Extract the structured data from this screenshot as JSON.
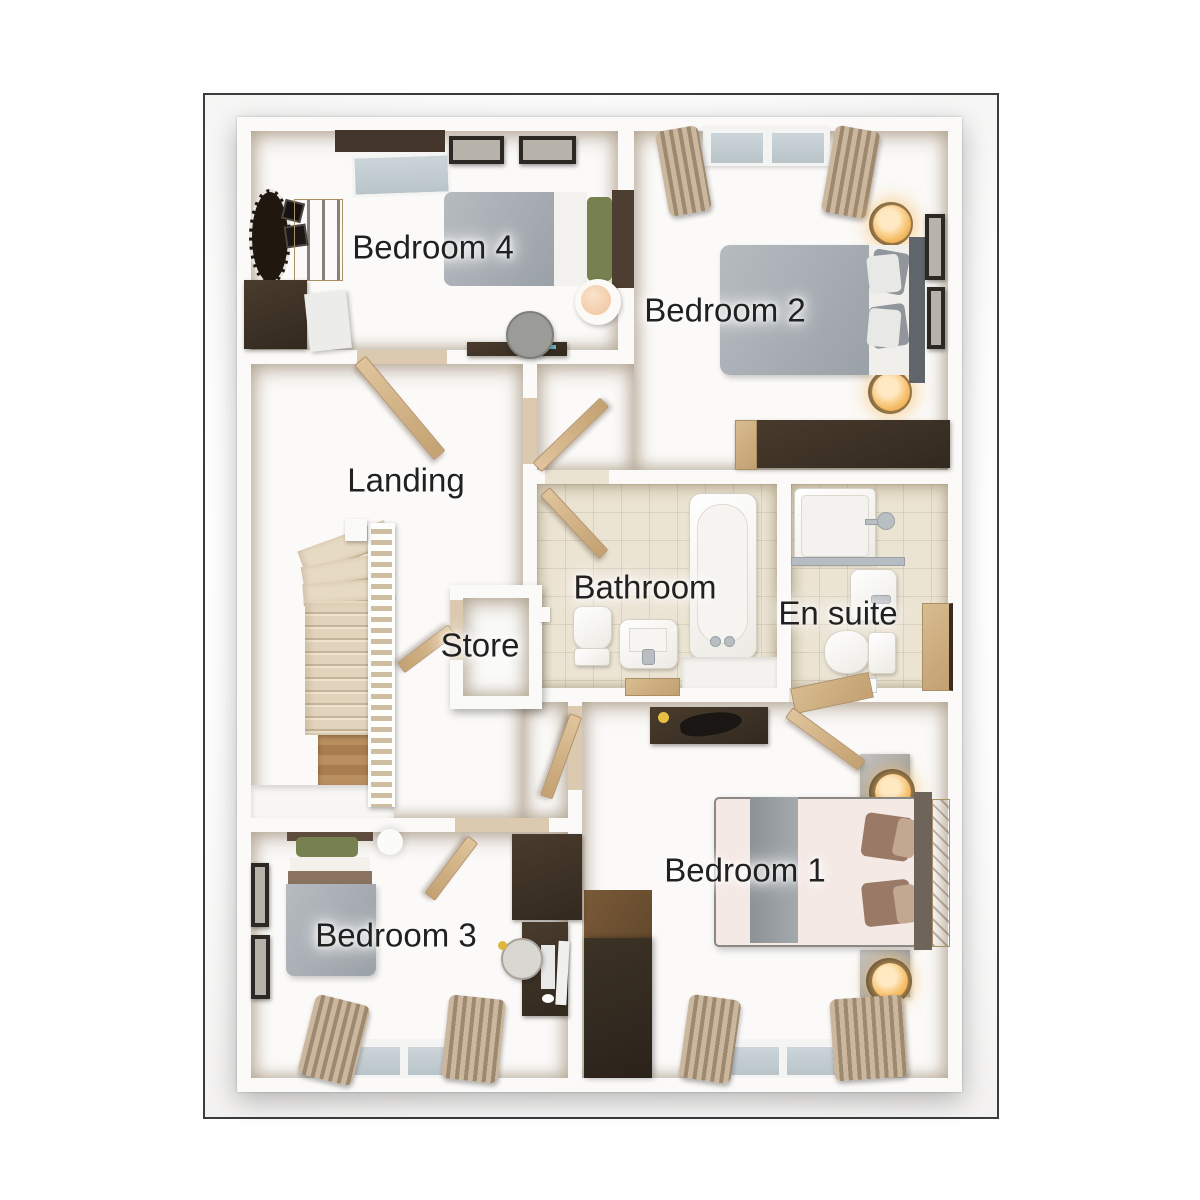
{
  "rooms": [
    {
      "id": "bedroom-4",
      "label": "Bedroom 4"
    },
    {
      "id": "bedroom-2",
      "label": "Bedroom 2"
    },
    {
      "id": "landing",
      "label": "Landing"
    },
    {
      "id": "store",
      "label": "Store"
    },
    {
      "id": "bathroom",
      "label": "Bathroom"
    },
    {
      "id": "en-suite",
      "label": "En suite"
    },
    {
      "id": "bedroom-3",
      "label": "Bedroom 3"
    },
    {
      "id": "bedroom-1",
      "label": "Bedroom 1"
    }
  ],
  "palette": {
    "frame_border": "#3c3c3c",
    "wall_white": "#fbfaf8",
    "carpet_beige": "#dccab0",
    "tile_cream": "#ece4d3",
    "dark_wood": "#3a2f23",
    "light_wood": "#c9a878",
    "bed_grey": "#a6acb1",
    "bed_pink": "#f5e9e5",
    "pillow_green": "#77814f",
    "lamp_amber": "#f0ae49",
    "window_glass": "#c9d3d7",
    "curtain_tan": "#c0ac93"
  }
}
